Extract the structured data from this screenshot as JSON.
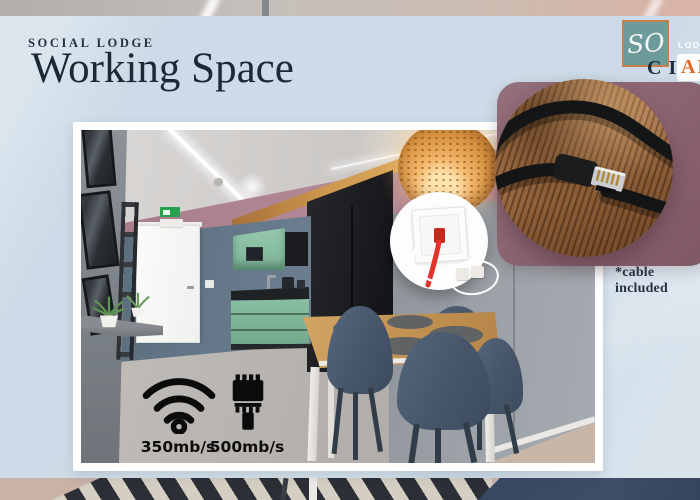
{
  "slide": {
    "eyebrow": "SOCIAL LODGE",
    "title": "Working Space"
  },
  "logo": {
    "monogram": "SO",
    "word_top": "LODGE",
    "word_bottom_dark": "CI",
    "word_bottom_accent": "AL"
  },
  "speeds": {
    "wifi_label": "350mb/s",
    "ethernet_label": "500mb/s"
  },
  "inset": {
    "note": "*cable included"
  },
  "colors": {
    "panel_blue": "#ccdbe7",
    "navy_text": "#1c2836",
    "mauve_backdrop": "#8d6470",
    "logo_teal": "#6d9b9b",
    "accent_orange": "#df6c2b",
    "kitchen_green": "#89bfa1",
    "wall_pink": "#b08b98",
    "chair_slate": "#46556a"
  }
}
